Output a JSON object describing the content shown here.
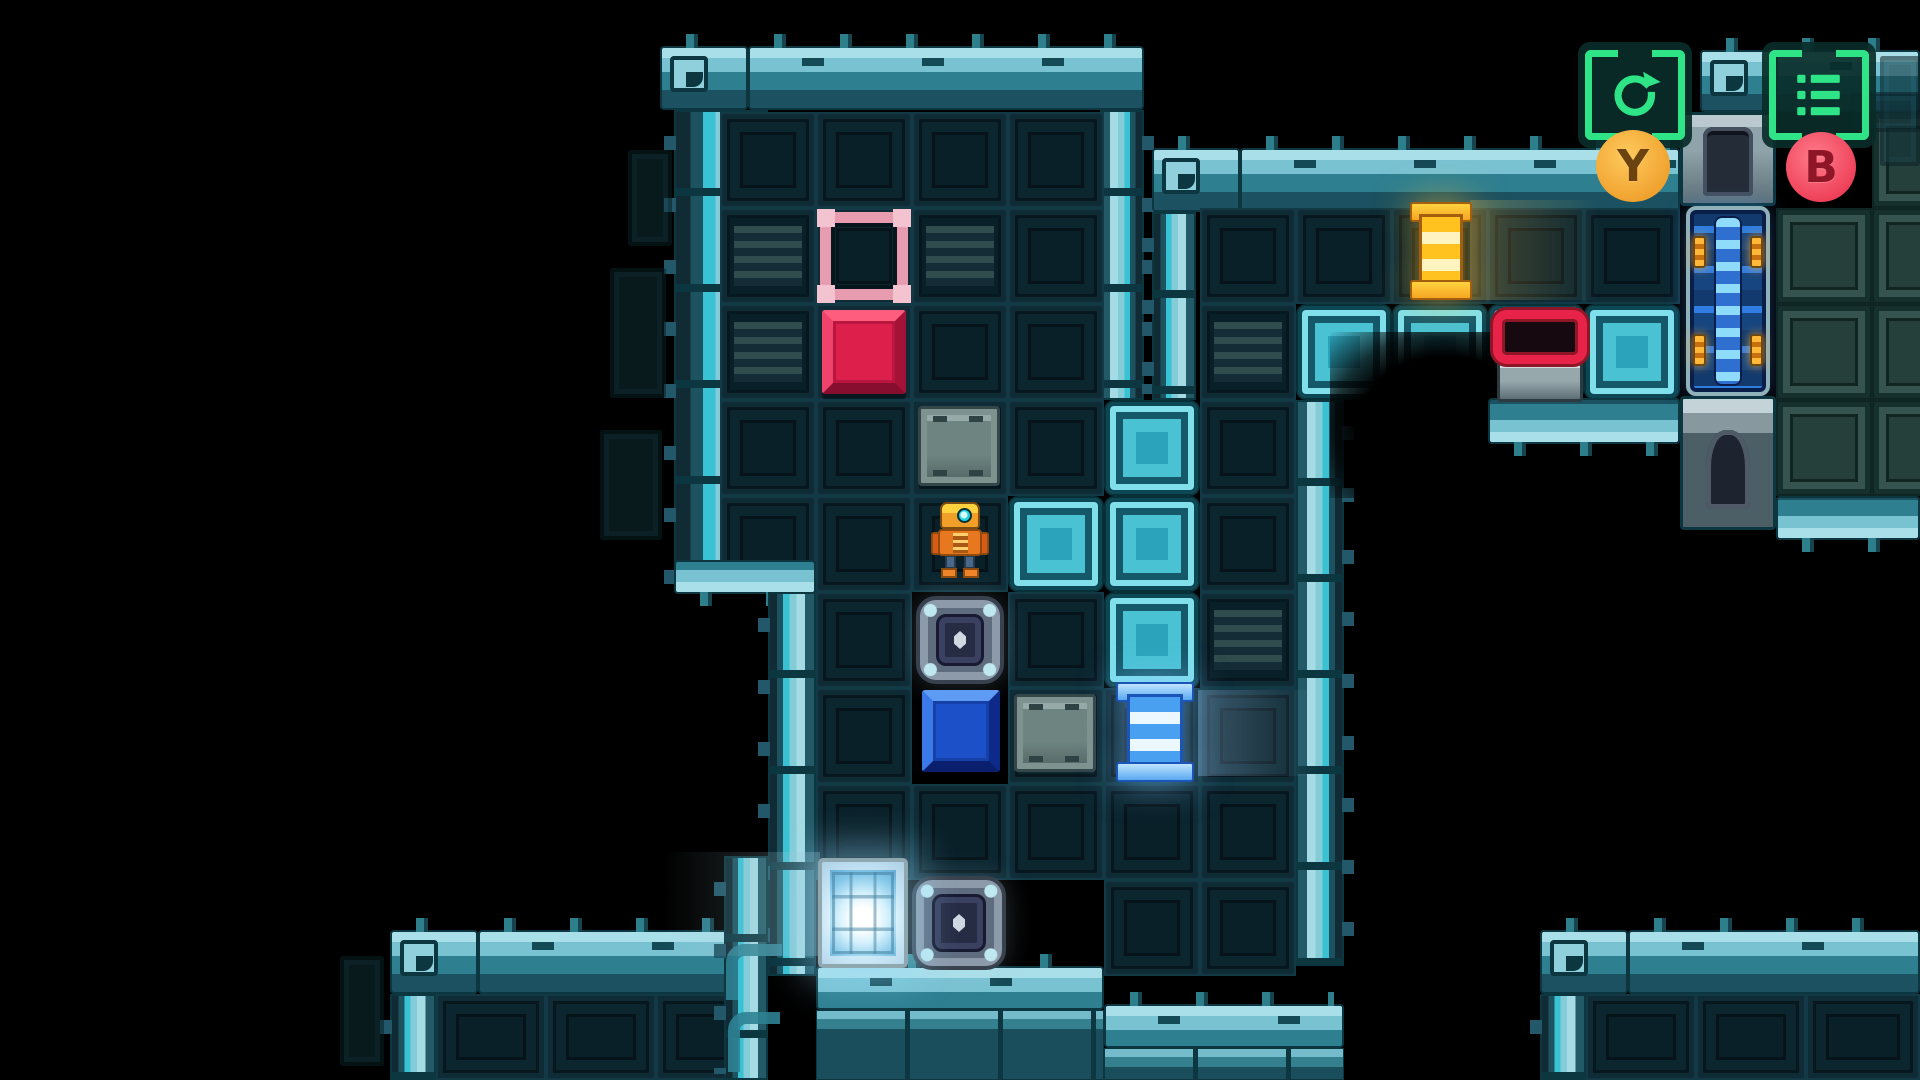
{
  "meta": {
    "scene": "sci-fi sokoban puzzle room with robot player",
    "background_color": "#000000"
  },
  "palette": {
    "wall_teal": "#2e7f90",
    "wall_light": "#a9dfe9",
    "machine_cyan": "#49c2d4",
    "floor_dark": "#0a2029",
    "accent_green": "#2ee487",
    "target_pink": "#e89cb0",
    "box_red": "#dd1f4c",
    "box_blue": "#1b50c8",
    "spool_yellow": "#f5a623",
    "spool_blue": "#5aa8f0",
    "switch_red": "#e8234a",
    "badge_y_color": "#f0a22e",
    "badge_b_color": "#ee4159",
    "robot_orange": "#f0a028"
  },
  "hud": {
    "restart": {
      "icon": "restart-icon",
      "button_label": "Y"
    },
    "menu": {
      "icon": "menu-list-icon",
      "button_label": "B"
    }
  },
  "map": {
    "tile_px": 96,
    "origin": {
      "x": 48,
      "y": 16
    },
    "tiles": [
      {
        "t": "WTc",
        "x": 660,
        "y": 46,
        "w": 88,
        "h": 64
      },
      {
        "t": "WT",
        "x": 748,
        "y": 46,
        "w": 396,
        "h": 64
      },
      {
        "t": "WL",
        "x": 674,
        "y": 110,
        "w": 94,
        "h": 482
      },
      {
        "t": "WR",
        "x": 1100,
        "y": 110,
        "w": 44,
        "h": 290
      },
      {
        "t": "F",
        "x": 720,
        "y": 112
      },
      {
        "t": "F",
        "x": 816,
        "y": 112
      },
      {
        "t": "F",
        "x": 912,
        "y": 112
      },
      {
        "t": "F",
        "x": 1008,
        "y": 112
      },
      {
        "t": "FV",
        "x": 720,
        "y": 208
      },
      {
        "t": "F",
        "x": 816,
        "y": 208
      },
      {
        "t": "FV",
        "x": 912,
        "y": 208
      },
      {
        "t": "F",
        "x": 1008,
        "y": 208
      },
      {
        "t": "FV",
        "x": 720,
        "y": 304
      },
      {
        "t": "F",
        "x": 816,
        "y": 304
      },
      {
        "t": "F",
        "x": 912,
        "y": 304
      },
      {
        "t": "F",
        "x": 1008,
        "y": 304
      },
      {
        "t": "F",
        "x": 720,
        "y": 400
      },
      {
        "t": "F",
        "x": 816,
        "y": 400
      },
      {
        "t": "F",
        "x": 912,
        "y": 400
      },
      {
        "t": "F",
        "x": 1008,
        "y": 400
      },
      {
        "t": "F",
        "x": 720,
        "y": 496
      },
      {
        "t": "F",
        "x": 816,
        "y": 496
      },
      {
        "t": "F",
        "x": 912,
        "y": 496
      },
      {
        "t": "WB",
        "x": 674,
        "y": 560,
        "w": 142,
        "h": 34
      },
      {
        "t": "CY",
        "x": 1008,
        "y": 496
      },
      {
        "t": "CY",
        "x": 1104,
        "y": 400
      },
      {
        "t": "CY",
        "x": 1104,
        "y": 496
      },
      {
        "t": "CY",
        "x": 1104,
        "y": 592
      },
      {
        "t": "WL",
        "x": 768,
        "y": 592,
        "w": 48,
        "h": 384
      },
      {
        "t": "F",
        "x": 816,
        "y": 592
      },
      {
        "t": "F",
        "x": 1008,
        "y": 592
      },
      {
        "t": "F",
        "x": 816,
        "y": 688
      },
      {
        "t": "F",
        "x": 1008,
        "y": 688
      },
      {
        "t": "F",
        "x": 1104,
        "y": 688
      },
      {
        "t": "F",
        "x": 816,
        "y": 784
      },
      {
        "t": "F",
        "x": 912,
        "y": 784
      },
      {
        "t": "F",
        "x": 1008,
        "y": 784
      },
      {
        "t": "F",
        "x": 1104,
        "y": 784
      },
      {
        "t": "F",
        "x": 1104,
        "y": 880
      },
      {
        "t": "F",
        "x": 1200,
        "y": 880
      },
      {
        "t": "F",
        "x": 1200,
        "y": 400
      },
      {
        "t": "F",
        "x": 1200,
        "y": 496
      },
      {
        "t": "FV",
        "x": 1200,
        "y": 592
      },
      {
        "t": "F",
        "x": 1200,
        "y": 688
      },
      {
        "t": "F",
        "x": 1200,
        "y": 784
      },
      {
        "t": "WR",
        "x": 1296,
        "y": 400,
        "w": 48,
        "h": 566
      },
      {
        "t": "WTc",
        "x": 1152,
        "y": 148,
        "w": 88,
        "h": 64
      },
      {
        "t": "WT",
        "x": 1240,
        "y": 148,
        "w": 440,
        "h": 64
      },
      {
        "t": "WL",
        "x": 1152,
        "y": 212,
        "w": 44,
        "h": 188
      },
      {
        "t": "F",
        "x": 1200,
        "y": 208
      },
      {
        "t": "F",
        "x": 1296,
        "y": 208
      },
      {
        "t": "F",
        "x": 1392,
        "y": 208
      },
      {
        "t": "F",
        "x": 1488,
        "y": 208
      },
      {
        "t": "F",
        "x": 1584,
        "y": 208
      },
      {
        "t": "FV",
        "x": 1200,
        "y": 304
      },
      {
        "t": "CY",
        "x": 1296,
        "y": 304
      },
      {
        "t": "CY",
        "x": 1392,
        "y": 304
      },
      {
        "t": "CY",
        "x": 1488,
        "y": 304
      },
      {
        "t": "CY",
        "x": 1584,
        "y": 304
      },
      {
        "t": "hole",
        "x": 1330,
        "y": 332,
        "w": 230,
        "h": 166
      },
      {
        "t": "WB",
        "x": 1488,
        "y": 398,
        "w": 192,
        "h": 46
      },
      {
        "t": "WTc",
        "x": 1700,
        "y": 50,
        "w": 76,
        "h": 62
      },
      {
        "t": "WT",
        "x": 1776,
        "y": 50,
        "w": 144,
        "h": 62
      },
      {
        "t": "MA",
        "x": 1680,
        "y": 112,
        "w": 96,
        "h": 94
      },
      {
        "t": "PIPE",
        "x": 1686,
        "y": 206,
        "w": 84,
        "h": 190
      },
      {
        "t": "MB",
        "x": 1680,
        "y": 396,
        "w": 96,
        "h": 134
      },
      {
        "t": "GR",
        "x": 1872,
        "y": 112
      },
      {
        "t": "GR",
        "x": 1776,
        "y": 208
      },
      {
        "t": "GR",
        "x": 1872,
        "y": 208
      },
      {
        "t": "GR",
        "x": 1776,
        "y": 304
      },
      {
        "t": "GR",
        "x": 1872,
        "y": 304
      },
      {
        "t": "GR",
        "x": 1776,
        "y": 400
      },
      {
        "t": "GR",
        "x": 1872,
        "y": 400
      },
      {
        "t": "WB",
        "x": 1776,
        "y": 496,
        "w": 144,
        "h": 44
      },
      {
        "t": "WTc",
        "x": 390,
        "y": 930,
        "w": 88,
        "h": 64
      },
      {
        "t": "WT",
        "x": 478,
        "y": 930,
        "w": 290,
        "h": 64
      },
      {
        "t": "WL",
        "x": 390,
        "y": 994,
        "w": 46,
        "h": 86
      },
      {
        "t": "F",
        "x": 436,
        "y": 994,
        "w": 110,
        "h": 86
      },
      {
        "t": "F",
        "x": 546,
        "y": 994,
        "w": 110,
        "h": 86
      },
      {
        "t": "F",
        "x": 656,
        "y": 994,
        "w": 112,
        "h": 86
      },
      {
        "t": "WT",
        "x": 816,
        "y": 966,
        "w": 288,
        "h": 44
      },
      {
        "t": "WT",
        "x": 1104,
        "y": 1004,
        "w": 240,
        "h": 44
      },
      {
        "t": "slab",
        "x": 816,
        "y": 1010,
        "w": 288,
        "h": 70
      },
      {
        "t": "slab",
        "x": 1104,
        "y": 1048,
        "w": 240,
        "h": 32
      },
      {
        "t": "WL",
        "x": 724,
        "y": 856,
        "w": 44,
        "h": 224
      },
      {
        "t": "WTc",
        "x": 1540,
        "y": 930,
        "w": 88,
        "h": 64
      },
      {
        "t": "WT",
        "x": 1628,
        "y": 930,
        "w": 292,
        "h": 64
      },
      {
        "t": "WL",
        "x": 1540,
        "y": 994,
        "w": 46,
        "h": 86
      },
      {
        "t": "F",
        "x": 1586,
        "y": 994,
        "w": 110,
        "h": 86
      },
      {
        "t": "F",
        "x": 1696,
        "y": 994,
        "w": 110,
        "h": 86
      },
      {
        "t": "F",
        "x": 1806,
        "y": 994,
        "w": 114,
        "h": 86
      },
      {
        "t": "decal",
        "x": 628,
        "y": 150,
        "w": 44,
        "h": 96
      },
      {
        "t": "decal",
        "x": 610,
        "y": 268,
        "w": 56,
        "h": 130
      },
      {
        "t": "decal",
        "x": 600,
        "y": 430,
        "w": 62,
        "h": 110
      },
      {
        "t": "decal",
        "x": 1880,
        "y": 56,
        "w": 40,
        "h": 110
      },
      {
        "t": "decal",
        "x": 1850,
        "y": 92,
        "w": 70,
        "h": 40
      },
      {
        "t": "decal",
        "x": 340,
        "y": 956,
        "w": 44,
        "h": 110
      },
      {
        "t": "elb",
        "x": 726,
        "y": 944,
        "w": 56,
        "h": 56
      },
      {
        "t": "elb",
        "x": 728,
        "y": 1012,
        "w": 52,
        "h": 60
      },
      {
        "t": "streak",
        "x": 664,
        "y": 852,
        "w": 156,
        "h": 104
      },
      {
        "t": "streakb",
        "x": 1198,
        "y": 690,
        "w": 120,
        "h": 86
      },
      {
        "t": "streaky",
        "x": 1470,
        "y": 200,
        "w": 130,
        "h": 100
      }
    ]
  },
  "sprites": [
    {
      "t": "target",
      "x": 820,
      "y": 212,
      "w": 88,
      "h": 88,
      "n": "goal-target"
    },
    {
      "t": "boxred",
      "x": 822,
      "y": 310,
      "w": 84,
      "h": 84,
      "n": "red-box"
    },
    {
      "t": "crate",
      "x": 918,
      "y": 406,
      "w": 82,
      "h": 80,
      "n": "metal-crate"
    },
    {
      "t": "crate",
      "x": 1014,
      "y": 694,
      "w": 82,
      "h": 78,
      "n": "metal-crate"
    },
    {
      "t": "hatch",
      "x": 916,
      "y": 596,
      "w": 88,
      "h": 88,
      "n": "hatch-door"
    },
    {
      "t": "hatch",
      "x": 912,
      "y": 876,
      "w": 94,
      "h": 94,
      "n": "hatch-door"
    },
    {
      "t": "pad",
      "x": 818,
      "y": 858,
      "w": 90,
      "h": 110,
      "n": "energized-pad"
    },
    {
      "t": "boxblue",
      "x": 922,
      "y": 690,
      "w": 78,
      "h": 82,
      "n": "blue-box"
    },
    {
      "t": "spool",
      "v": "blue",
      "x": 1116,
      "y": 682,
      "w": 78,
      "h": 100,
      "n": "blue-spool"
    },
    {
      "t": "spool",
      "v": "yellow",
      "x": 1410,
      "y": 202,
      "w": 62,
      "h": 98,
      "n": "yellow-spool"
    },
    {
      "t": "switch",
      "x": 1492,
      "y": 306,
      "w": 96,
      "h": 96,
      "n": "red-switch"
    },
    {
      "t": "robot",
      "x": 933,
      "y": 502,
      "w": 54,
      "h": 76,
      "n": "player-robot"
    }
  ]
}
